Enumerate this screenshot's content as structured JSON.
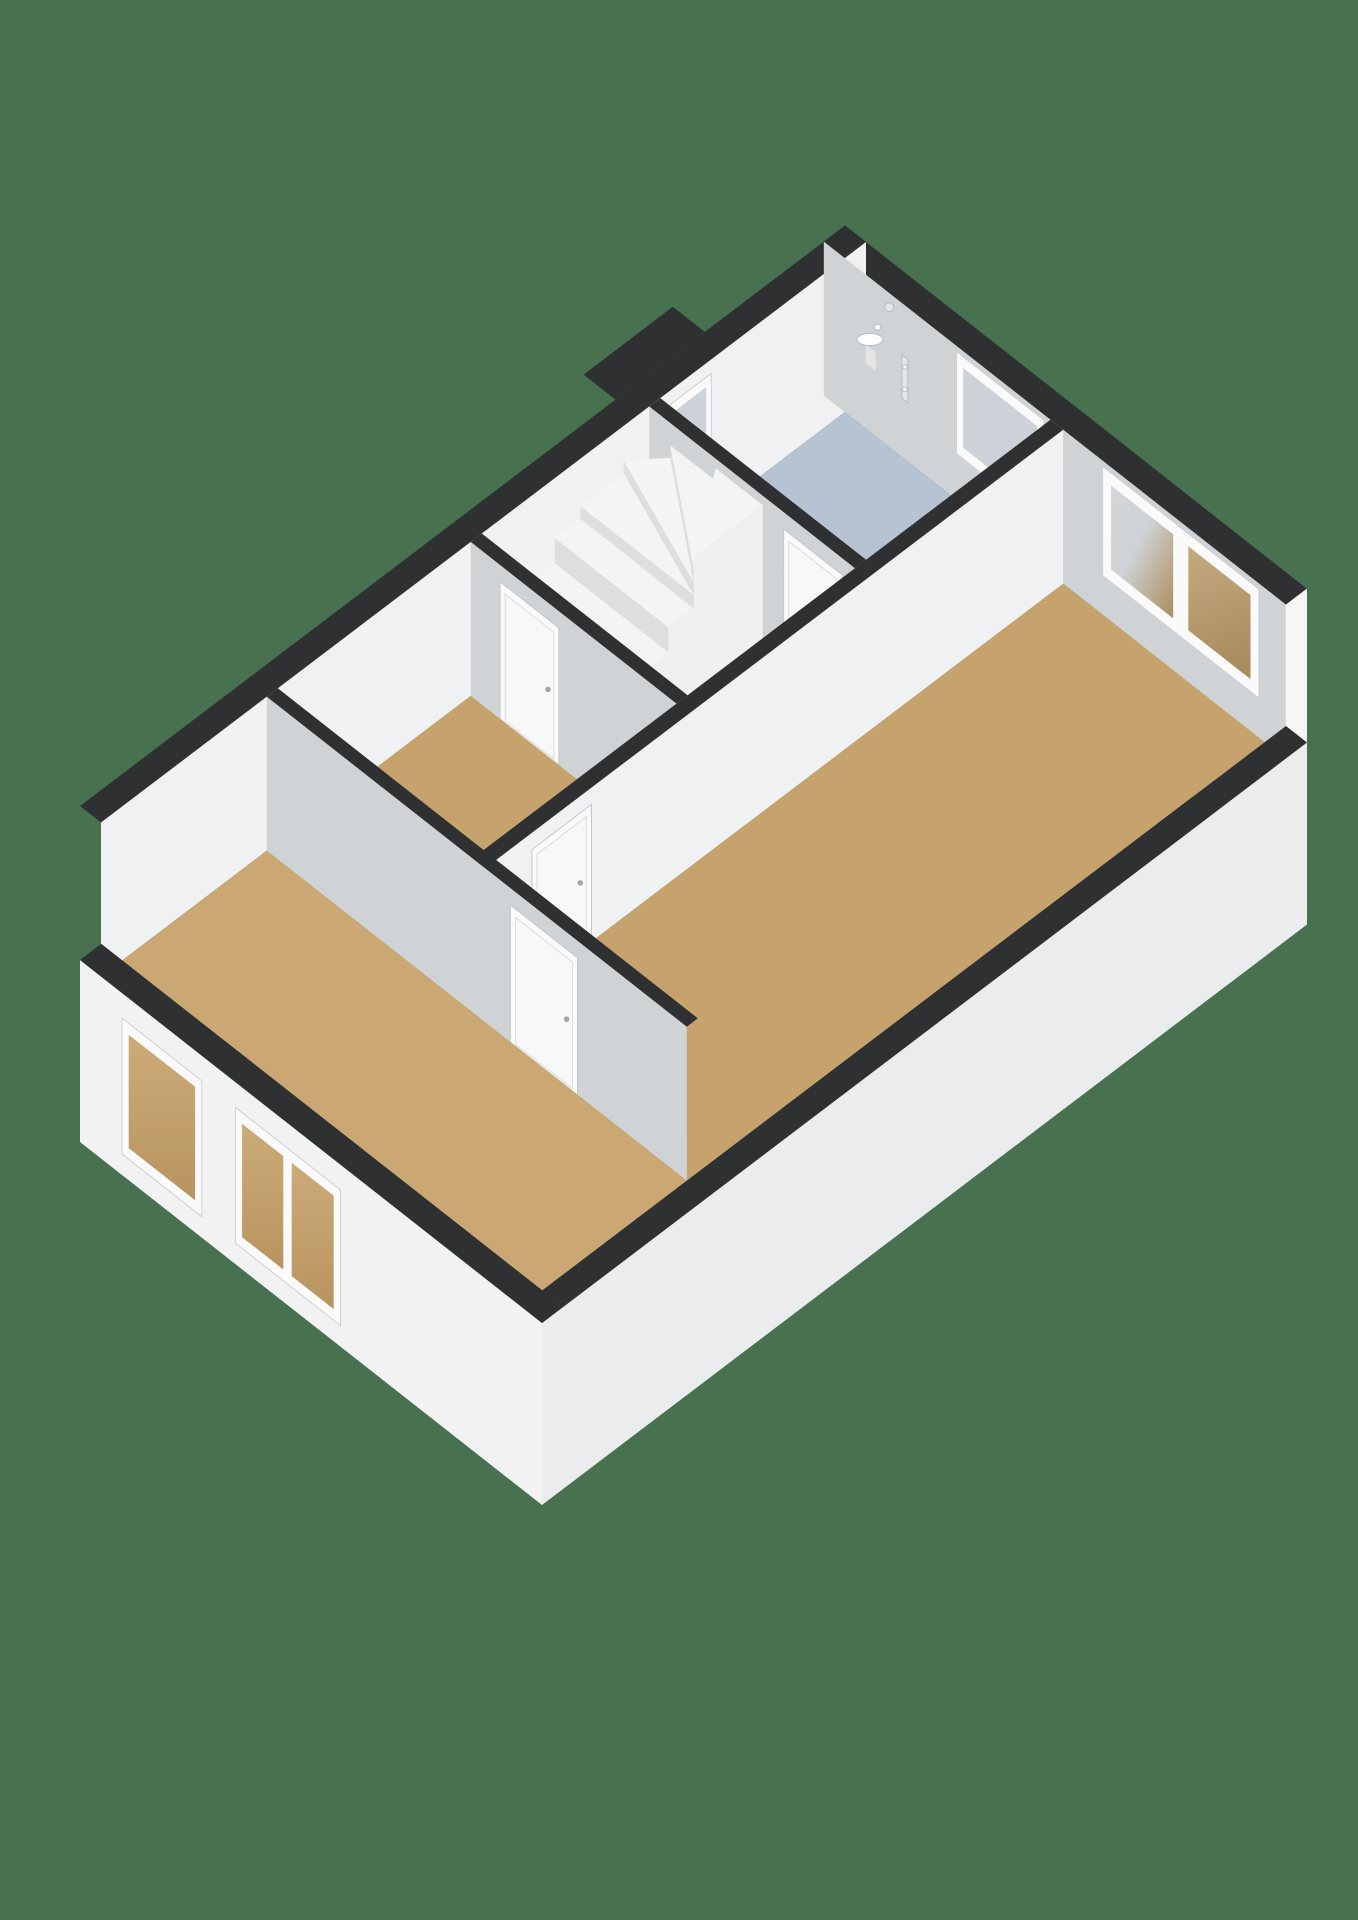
{
  "canvas": {
    "width": 1358,
    "height": 1920,
    "background": "#48714F"
  },
  "palette": {
    "wall_cap": "#2e3032",
    "wall_white": "#f0f1f2",
    "wall_grey": "#d0d3d5",
    "facade_front": "#f2f2f3",
    "facade_side": "#ebecee",
    "facade_back": "#f6f6f6",
    "floor_wood": "#c6a26d",
    "floor_wood_light": "#cba873",
    "floor_bath": "#b5c3d3",
    "floor_hall": "#e8e9ea",
    "stair_tread": "#f3f4f5",
    "stair_riser": "#dcdee0",
    "stair_stringer": "#eef0f1",
    "window_frame": "#fafafa",
    "window_frame_edge": "#cfcfcf",
    "glass_cool": "#ccd2d7",
    "glass_warm": "#b2966b",
    "door_leaf": "#f7f8f8",
    "door_frame_edge": "#c6c6c6",
    "handle": "#a6a6a6",
    "fixture_light": "#e3e5e7",
    "fixture_edge": "#b9bcbf",
    "hole": "#48714F",
    "slab_edge": "#e6e7e9"
  },
  "scene": {
    "type": "3d-floor-plan",
    "view": "isometric-cutaway-upper-floor",
    "rooms": [
      {
        "name": "bathroom",
        "floor_color_key": "floor_bath"
      },
      {
        "name": "landing-with-stairs",
        "floor_color_key": "floor_hall"
      },
      {
        "name": "left-bedroom",
        "floor_color_key": "floor_wood"
      },
      {
        "name": "right-bedroom",
        "floor_color_key": "floor_wood"
      },
      {
        "name": "front-bedroom",
        "floor_color_key": "floor_wood_light"
      }
    ],
    "fixtures": [
      "wash-basin",
      "shower-mixer",
      "mirror"
    ],
    "windows": [
      "nw-small-window",
      "bathroom-window",
      "right-bedroom-window",
      "front-facade-window-left",
      "front-facade-window-right"
    ],
    "stairs": "winder-staircase",
    "doors": [
      "bathroom-door",
      "left-bedroom-door",
      "right-bedroom-door",
      "front-bedroom-door"
    ]
  }
}
